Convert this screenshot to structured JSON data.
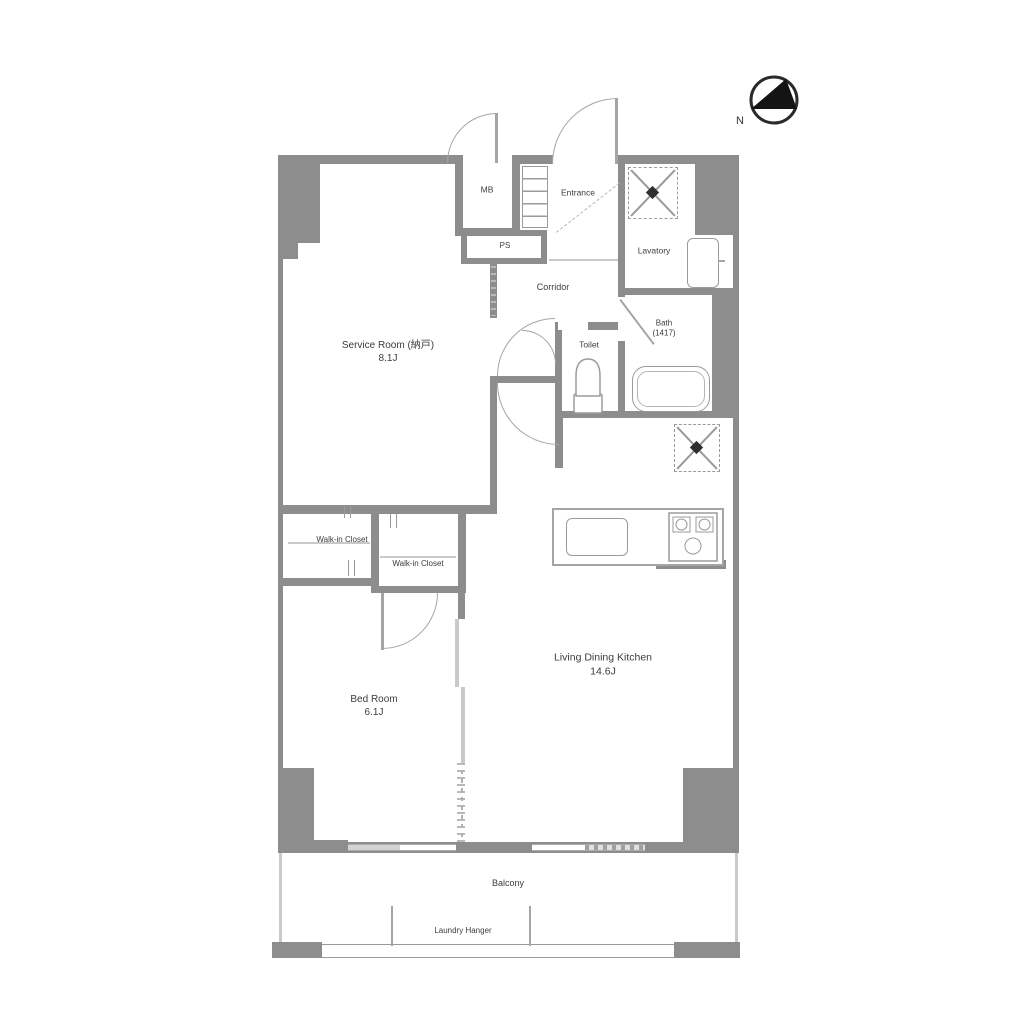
{
  "compass": {
    "north_label": "N"
  },
  "rooms": {
    "mb": {
      "label": "MB"
    },
    "ps": {
      "label": "PS"
    },
    "entrance": {
      "label": "Entrance"
    },
    "lavatory": {
      "label": "Lavatory"
    },
    "bath": {
      "label": "Bath",
      "size": "(1417)"
    },
    "toilet": {
      "label": "Toilet"
    },
    "corridor": {
      "label": "Corridor"
    },
    "service_room": {
      "label": "Service Room (納戸)",
      "area": "8.1J"
    },
    "walk_in_closet_left": {
      "label": "Walk-in Closet"
    },
    "walk_in_closet_right": {
      "label": "Walk-in Closet"
    },
    "bedroom": {
      "label": "Bed Room",
      "area": "6.1J"
    },
    "ldk": {
      "label": "Living Dining Kitchen",
      "area": "14.6J"
    },
    "balcony": {
      "label": "Balcony"
    },
    "laundry_hanger": {
      "label": "Laundry Hanger"
    }
  },
  "colors": {
    "wall": "#8d8d8d",
    "line": "#9b9b9b",
    "text": "#3c3c3c",
    "window": "#d4d4d4"
  }
}
